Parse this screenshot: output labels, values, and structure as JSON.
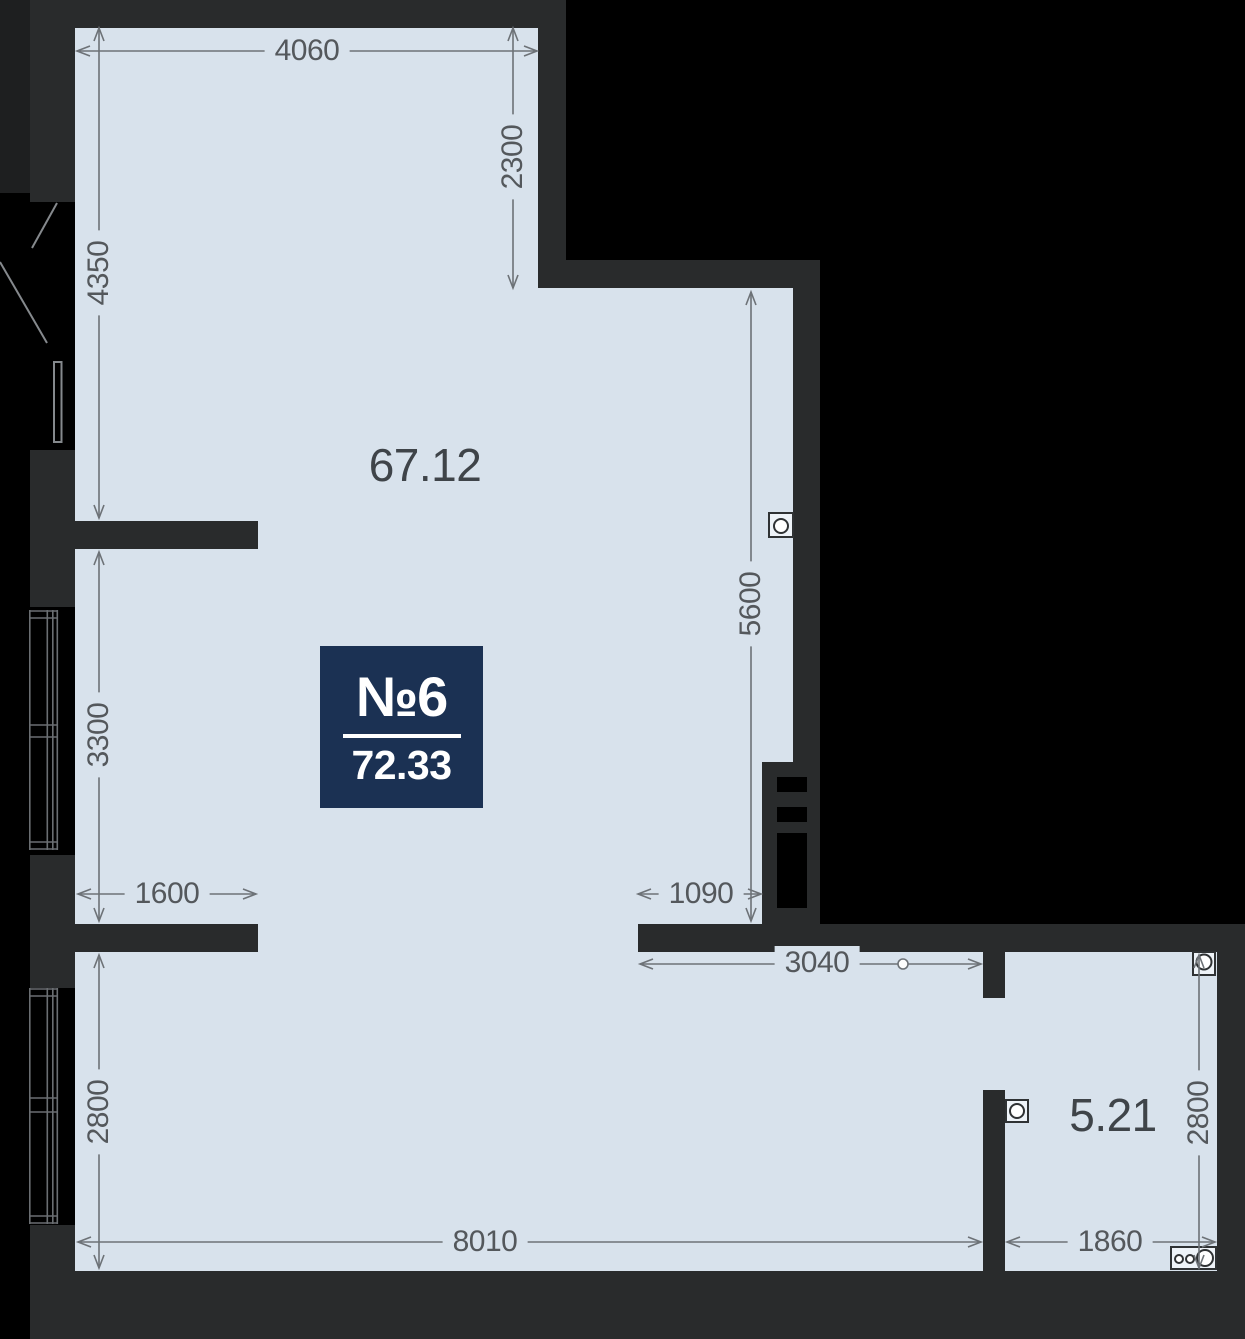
{
  "plan": {
    "unit_badge": {
      "number": "№6",
      "total_area": "72.33"
    },
    "room_areas": {
      "main": "67.12",
      "small": "5.21"
    },
    "dimensions": {
      "top_width": "4060",
      "upper_step_height": "2300",
      "left_height_upper": "4350",
      "left_height_middle": "3300",
      "left_height_lower": "2800",
      "left_stub_width": "1600",
      "middle_opening_width": "1090",
      "right_height_upper": "5600",
      "middle_lower_width": "3040",
      "bottom_width": "8010",
      "small_room_width": "1860",
      "small_room_height": "2800"
    },
    "colors": {
      "bg": "#000000",
      "wall": "#292b2c",
      "floor": "#d8e2ec",
      "dimtext": "#54585c",
      "dimline": "#6d7277",
      "navy": "#1b3153",
      "areatext": "#3f4449"
    }
  }
}
